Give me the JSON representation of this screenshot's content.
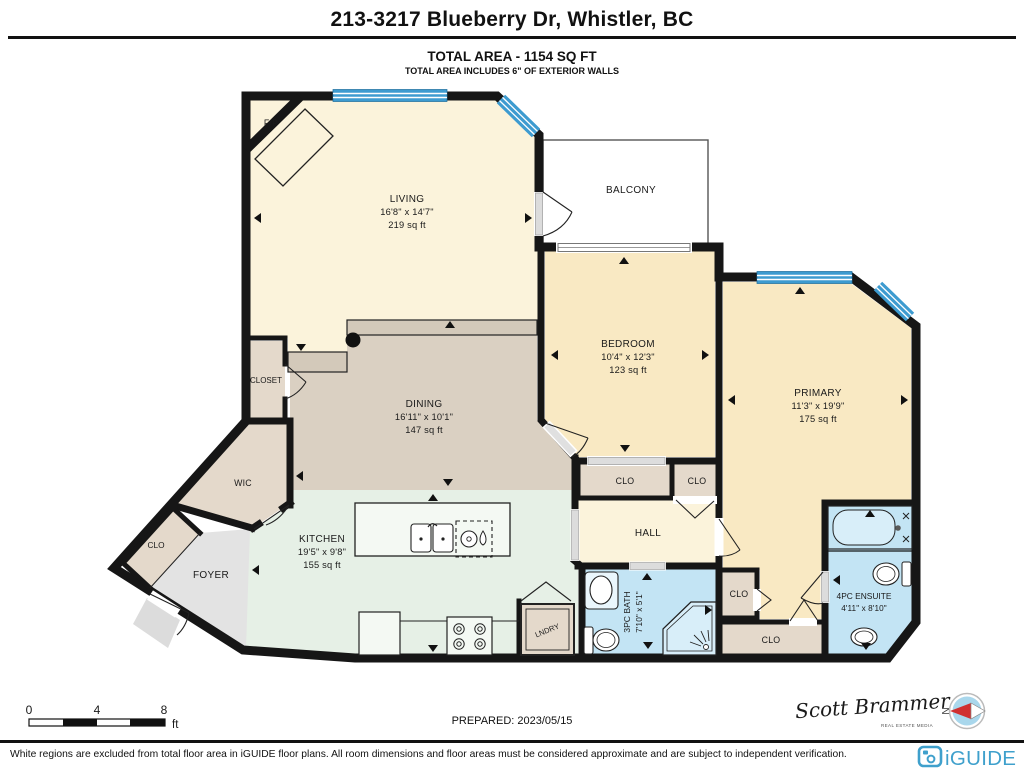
{
  "header": {
    "title": "213-3217 Blueberry Dr, Whistler, BC",
    "total_area": "TOTAL AREA - 1154 SQ FT",
    "note": "TOTAL AREA INCLUDES 6\" OF EXTERIOR WALLS"
  },
  "rooms": {
    "living": {
      "name": "LIVING",
      "dims": "16'8\" x 14'7\"",
      "area": "219 sq ft"
    },
    "dining": {
      "name": "DINING",
      "dims": "16'11\" x 10'1\"",
      "area": "147 sq ft"
    },
    "kitchen": {
      "name": "KITCHEN",
      "dims": "19'5\" x 9'8\"",
      "area": "155 sq ft"
    },
    "bedroom": {
      "name": "BEDROOM",
      "dims": "10'4\" x 12'3\"",
      "area": "123 sq ft"
    },
    "primary": {
      "name": "PRIMARY",
      "dims": "11'3\" x 19'9\"",
      "area": "175 sq ft"
    },
    "bath3pc": {
      "name": "3PC BATH",
      "dims": "7'10\" x 5'1\""
    },
    "ensuite": {
      "name": "4PC ENSUITE",
      "dims": "4'11\" x 8'10\""
    },
    "balcony": "BALCONY",
    "hall": "HALL",
    "foyer": "FOYER",
    "wic": "WIC",
    "closet": "CLOSET",
    "clo": "CLO",
    "fireplace": "F/P",
    "laundry": "LNDRY"
  },
  "scale_bar": {
    "t0": "0",
    "t4": "4",
    "t8": "8",
    "unit": "ft"
  },
  "footer": {
    "prepared": "PREPARED: 2023/05/15",
    "signature": "Scott Brammer",
    "signature_sub": "REAL ESTATE MEDIA",
    "compass_n": "N",
    "disclaimer": "White regions are excluded from total floor area in iGUIDE floor plans. All room dimensions and floor areas must be considered approximate and are subject to independent verification.",
    "brand": "iGUIDE"
  },
  "colors": {
    "wall": "#161616",
    "window_blue": "#3D9BD0",
    "living_cream": "#FBF3DB",
    "bedroom_peach": "#F9E9C3",
    "dining_tan": "#DAD0C2",
    "kitchen_green": "#E6F0E6",
    "bath_blue": "#C3E4F4",
    "closet_tan": "#E4D9CB",
    "foyer_gray": "#E3E3E3",
    "brand_blue": "#3FA0CC",
    "compass_red": "#D03030"
  }
}
